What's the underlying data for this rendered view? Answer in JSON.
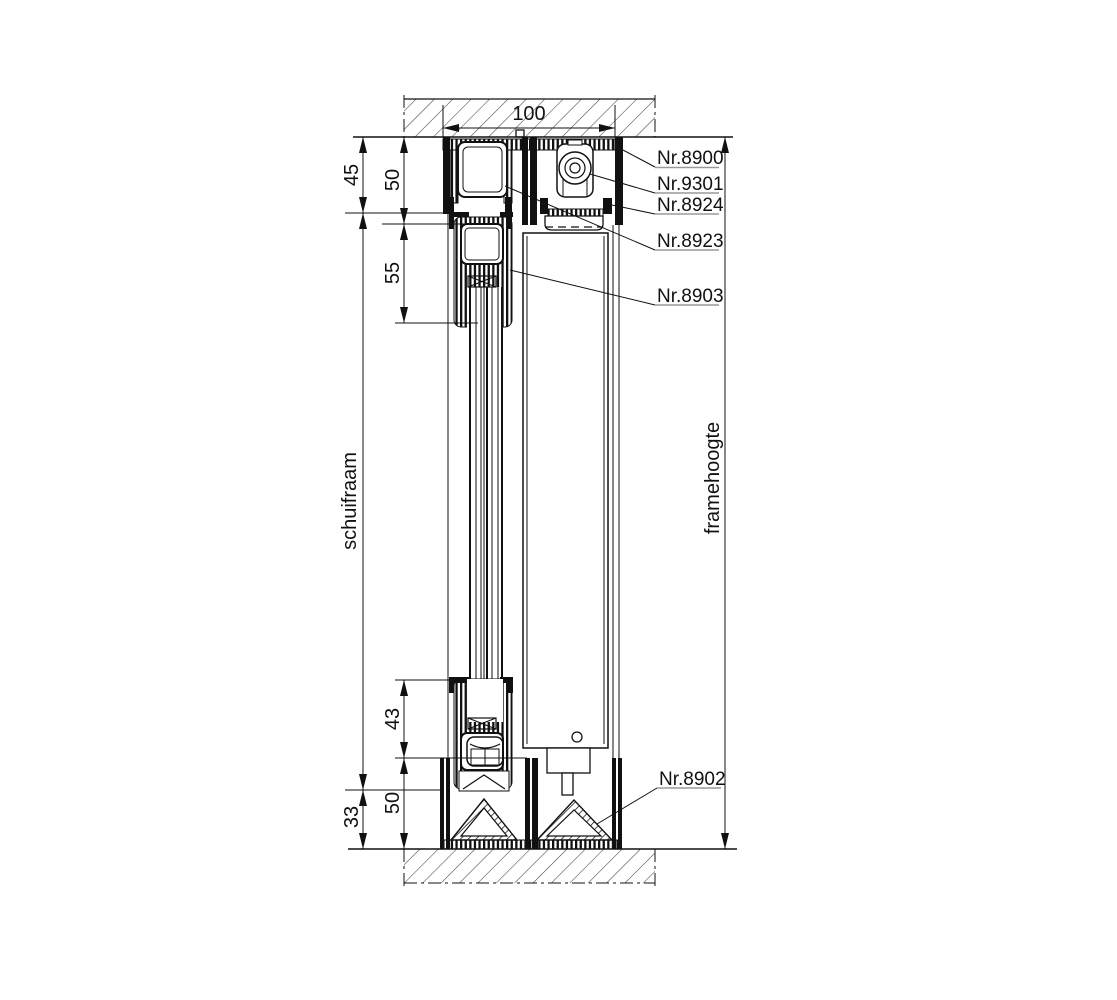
{
  "drawing": {
    "background": "#ffffff",
    "line_color": "#111111",
    "underline_color": "#9a9a9a",
    "dimensions": {
      "top_width": "100",
      "head_offset": "45",
      "head_profile": "50",
      "sash_top_profile": "55",
      "sash_bottom_inset": "43",
      "sill_profile": "50",
      "sill_offset": "33",
      "sash_height_label": "schuifraam",
      "frame_height_label": "framehoogte"
    },
    "part_labels": [
      {
        "text": "Nr.8900"
      },
      {
        "text": "Nr.9301"
      },
      {
        "text": "Nr.8924"
      },
      {
        "text": "Nr.8923"
      },
      {
        "text": "Nr.8903"
      },
      {
        "text": "Nr.8902"
      }
    ]
  }
}
